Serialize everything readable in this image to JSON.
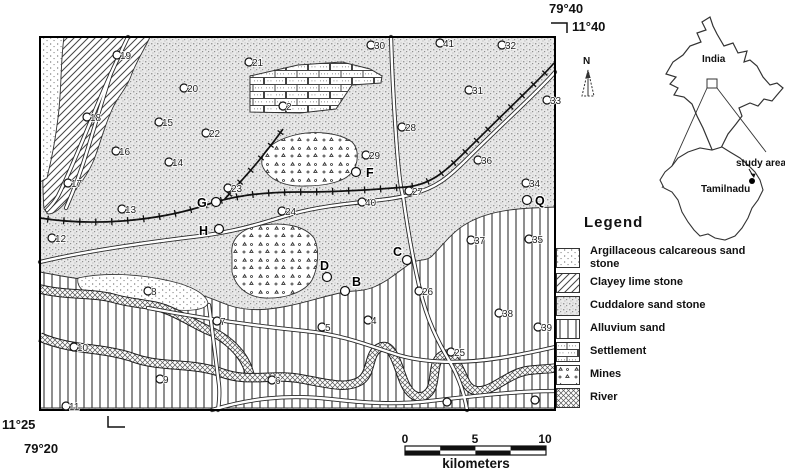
{
  "map": {
    "corner_labels": {
      "top_lon": "79°40",
      "top_lat": "11°40",
      "bottom_lat": "11°25",
      "bottom_lon": "79°20"
    },
    "north_label": "N",
    "points": [
      {
        "label": "19",
        "x": 117,
        "y": 55
      },
      {
        "label": "21",
        "x": 249,
        "y": 62
      },
      {
        "label": "30",
        "x": 371,
        "y": 45
      },
      {
        "label": "41",
        "x": 440,
        "y": 43
      },
      {
        "label": "32",
        "x": 502,
        "y": 45
      },
      {
        "label": "20",
        "x": 184,
        "y": 88
      },
      {
        "label": "31",
        "x": 469,
        "y": 90
      },
      {
        "label": "33",
        "x": 547,
        "y": 100
      },
      {
        "label": "2",
        "x": 283,
        "y": 106
      },
      {
        "label": "18",
        "x": 87,
        "y": 117
      },
      {
        "label": "15",
        "x": 159,
        "y": 122
      },
      {
        "label": "28",
        "x": 402,
        "y": 127
      },
      {
        "label": "22",
        "x": 206,
        "y": 133
      },
      {
        "label": "16",
        "x": 116,
        "y": 151
      },
      {
        "label": "29",
        "x": 366,
        "y": 155
      },
      {
        "label": "36",
        "x": 478,
        "y": 160
      },
      {
        "label": "14",
        "x": 169,
        "y": 162
      },
      {
        "label": "17",
        "x": 68,
        "y": 183
      },
      {
        "label": "34",
        "x": 526,
        "y": 183
      },
      {
        "label": "23",
        "x": 228,
        "y": 188
      },
      {
        "label": "27",
        "x": 409,
        "y": 191
      },
      {
        "label": "40",
        "x": 362,
        "y": 202
      },
      {
        "label": "13",
        "x": 122,
        "y": 209
      },
      {
        "label": "24",
        "x": 282,
        "y": 211
      },
      {
        "label": "12",
        "x": 52,
        "y": 238
      },
      {
        "label": "35",
        "x": 529,
        "y": 239
      },
      {
        "label": "37",
        "x": 471,
        "y": 240
      },
      {
        "label": "8",
        "x": 148,
        "y": 291
      },
      {
        "label": "26",
        "x": 419,
        "y": 291
      },
      {
        "label": "38",
        "x": 499,
        "y": 313
      },
      {
        "label": "4",
        "x": 368,
        "y": 320
      },
      {
        "label": "7",
        "x": 217,
        "y": 321
      },
      {
        "label": "5",
        "x": 322,
        "y": 327
      },
      {
        "label": "39",
        "x": 538,
        "y": 327
      },
      {
        "label": "10",
        "x": 74,
        "y": 347
      },
      {
        "label": "25",
        "x": 451,
        "y": 352
      },
      {
        "label": "9",
        "x": 160,
        "y": 379
      },
      {
        "label": "6",
        "x": 272,
        "y": 380
      },
      {
        "label": "",
        "x": 447,
        "y": 402
      },
      {
        "label": "",
        "x": 535,
        "y": 400
      },
      {
        "label": "11",
        "x": 66,
        "y": 406
      },
      {
        "label": "G",
        "x": 216,
        "y": 202,
        "lx": 197,
        "ly": 207,
        "bold": true
      },
      {
        "label": "H",
        "x": 219,
        "y": 229,
        "lx": 199,
        "ly": 235,
        "bold": true
      },
      {
        "label": "F",
        "x": 356,
        "y": 172,
        "lx": 366,
        "ly": 177,
        "bold": true
      },
      {
        "label": "D",
        "x": 327,
        "y": 277,
        "lx": 320,
        "ly": 270,
        "bold": true
      },
      {
        "label": "B",
        "x": 345,
        "y": 291,
        "lx": 352,
        "ly": 286,
        "bold": true
      },
      {
        "label": "C",
        "x": 407,
        "y": 260,
        "lx": 393,
        "ly": 256,
        "bold": true
      },
      {
        "label": "Q",
        "x": 527,
        "y": 200,
        "lx": 535,
        "ly": 205,
        "bold": true
      }
    ]
  },
  "inset": {
    "country": "India",
    "state": "Tamilnadu",
    "study_area": "study area"
  },
  "legend": {
    "title": "Legend",
    "items": [
      {
        "label": "Argillaceous calcareous sand stone",
        "pattern": "argillaceous"
      },
      {
        "label": "Clayey lime stone",
        "pattern": "clayey"
      },
      {
        "label": "Cuddalore sand stone",
        "pattern": "cuddalore"
      },
      {
        "label": "Alluvium sand",
        "pattern": "alluvium"
      },
      {
        "label": "Settlement",
        "pattern": "settlement"
      },
      {
        "label": "Mines",
        "pattern": "mines"
      },
      {
        "label": "River",
        "pattern": "river"
      }
    ]
  },
  "scale_bar": {
    "ticks": [
      "0",
      "5",
      "10"
    ],
    "unit": "kilometers"
  }
}
